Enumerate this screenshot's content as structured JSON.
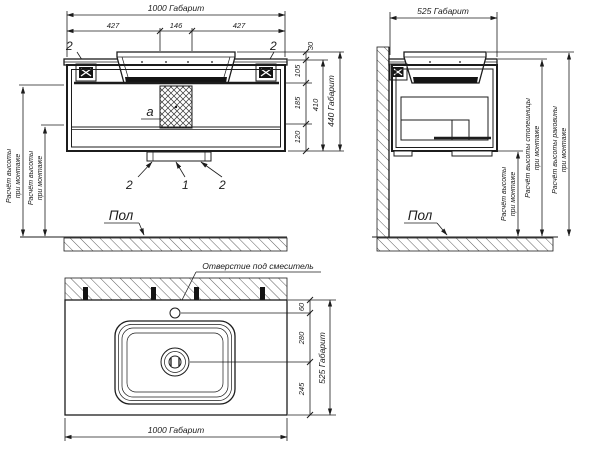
{
  "colors": {
    "line": "#1c1c1c",
    "background": "#ffffff"
  },
  "front_view": {
    "dim_width_total": "1000 Габарит",
    "dim_w1": "427",
    "dim_w2": "146",
    "dim_w3": "427",
    "dim_overhang": "30",
    "dim_h1": "105",
    "dim_h2": "185",
    "dim_h3": "120",
    "dim_cabinet_height": "410",
    "dim_height_total": "440 Габарит",
    "callout_bracket_left": "2",
    "callout_bracket_right": "2",
    "callout_drain_left": "2",
    "callout_drain_center": "1",
    "callout_drain_right": "2",
    "callout_siphon": "a",
    "floor_label": "Пол",
    "note_mount_a_line1": "Расчёт высоты",
    "note_mount_a_line2": "при монтаже",
    "note_mount_b_line1": "Расчёт высоты",
    "note_mount_b_line2": "при монтаже"
  },
  "side_view": {
    "dim_depth_total": "525 Габарит",
    "floor_label": "Пол",
    "note_mount_line1": "Расчёт высоты",
    "note_mount_line2": "при монтаже",
    "note_countertop_line1": "Расчёт высоты столешницы",
    "note_countertop_line2": "при монтаже",
    "note_sink_line1": "Расчёт высоты раковины",
    "note_sink_line2": "при монтаже"
  },
  "top_view": {
    "faucet_hole_label": "Отверстие под смеситель",
    "dim_faucet_offset": "60",
    "dim_faucet_to_drain": "280",
    "dim_drain_to_front": "245",
    "dim_depth_total": "525 Габарит",
    "dim_width_total": "1000 Габарит"
  }
}
